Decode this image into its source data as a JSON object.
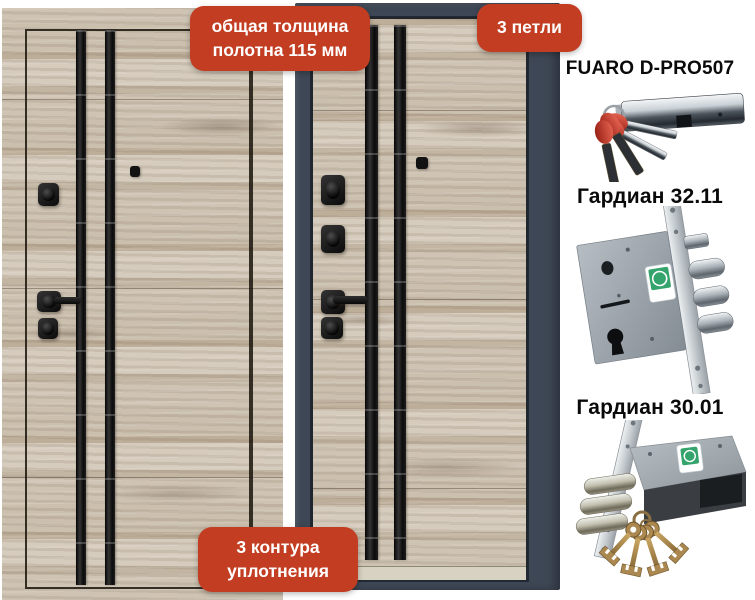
{
  "badges": {
    "thickness": "общая толщина полотна 115 мм",
    "hinges": "3 петли",
    "seals": "3 контура уплотнения"
  },
  "products": [
    {
      "title": "FUARO D-PRO507",
      "image": "lock-cylinder-with-red-cap-keys"
    },
    {
      "title": "Гардиан 32.11",
      "image": "mortise-lock-three-bolts"
    },
    {
      "title": "Гардиан 30.01",
      "image": "mortise-lock-with-brass-keys"
    }
  ],
  "colors": {
    "badge_bg": "#c23d21",
    "badge_text": "#ffffff",
    "door_frame": "#3e4755",
    "wood_base": "#c9bdac",
    "stripe_black": "#111111",
    "sticker_green": "#34a46c"
  }
}
